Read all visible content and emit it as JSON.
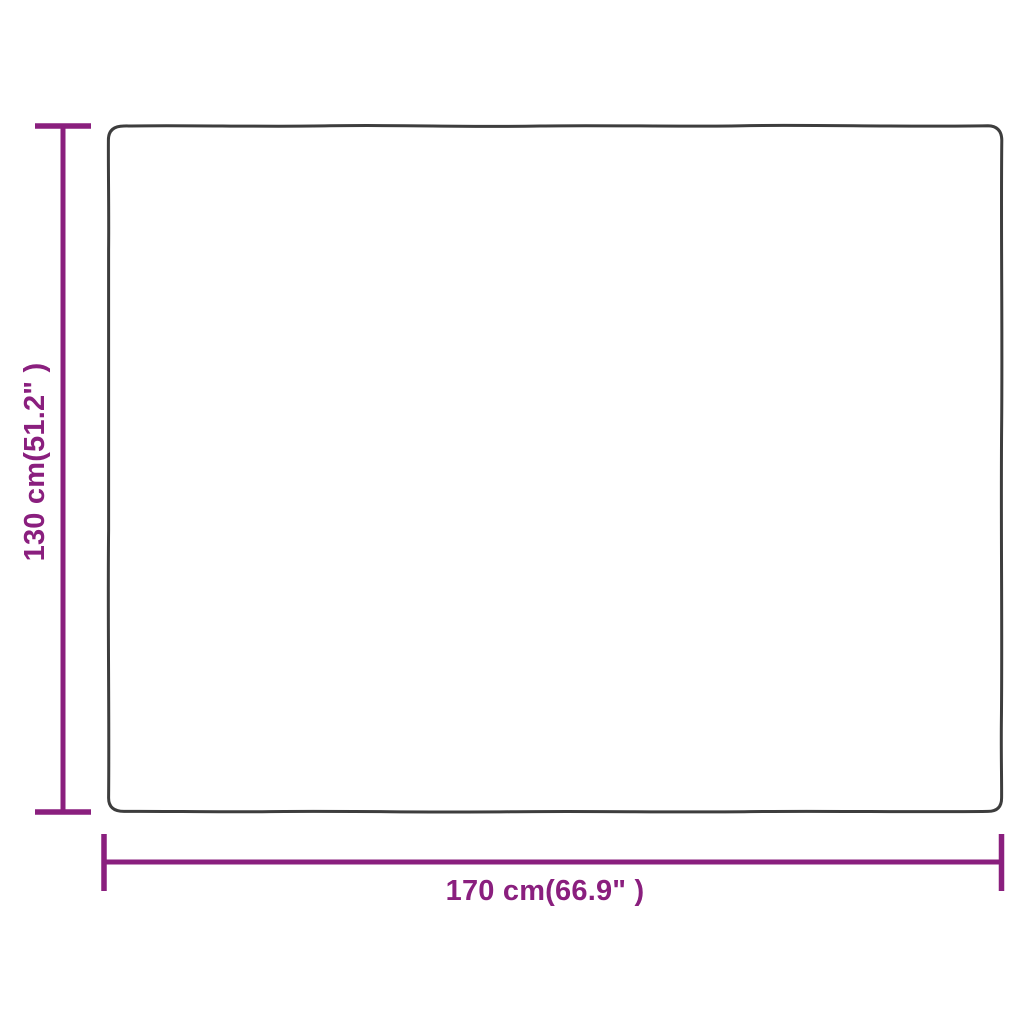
{
  "diagram": {
    "height_label": "130 cm(51.2\" )",
    "width_label": "170 cm(66.9\" )",
    "accent_color": "#8A1F7E",
    "outline_color": "#3D3D3D",
    "background_color": "#FFFFFF"
  }
}
